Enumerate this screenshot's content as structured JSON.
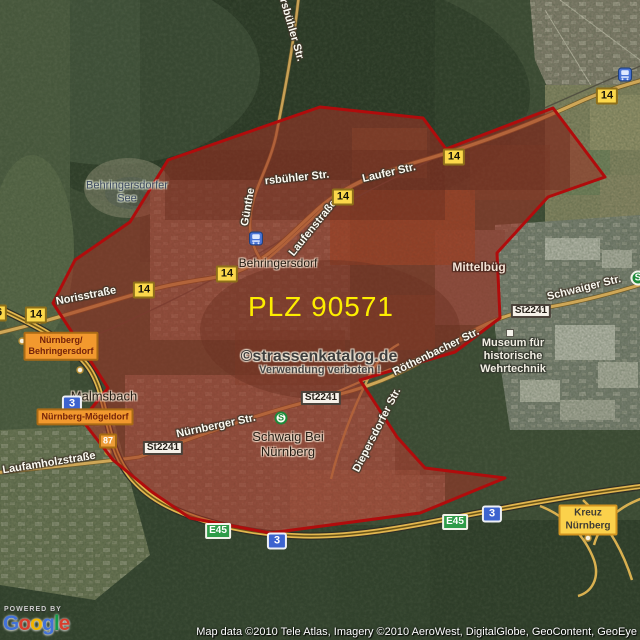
{
  "plz_overlay": {
    "label": "PLZ 90571",
    "fill_color": "#9e3326",
    "border_color": "#b00c0c",
    "label_color": "#fdee00"
  },
  "watermark": {
    "line1": "©strassenkatalog.de",
    "line2": "Verwendung verboten !"
  },
  "places": {
    "see_line1": "Behringersdorfer",
    "see_line2": "See",
    "behringersdorf": "Behringersdorf",
    "mittelbueg": "Mittelbüg",
    "malmsbach": "Malmsbach",
    "schwaig_line1": "Schwaig Bei",
    "schwaig_line2": "Nürnberg",
    "museum_line1": "Museum für",
    "museum_line2": "historische",
    "museum_line3": "Wehrtechnik"
  },
  "streets": {
    "norisstrasse": "Norisstraße",
    "laufer_str": "Laufer Str.",
    "lauferstrasse": "Laufenstraße",
    "guenthersbuehler_vertical": "Günthe",
    "guenthersbuehler_horizontal": "rsbühler Str.",
    "top_edge_street": "ersbühler Str.",
    "schwaiger_str": "Schwaiger Str.",
    "roethenbacher_str": "Röthenbacher Str.",
    "nuernberger_str": "Nürnberger Str.",
    "diepersdorfer_str": "Diepersdorfer Str.",
    "laufamholzstrasse": "Laufamholzstraße"
  },
  "shields": {
    "b14": "14",
    "b36": "36",
    "b87": "87",
    "st2241": "St2241",
    "e45": "E45",
    "a3": "3"
  },
  "signs": {
    "exit_nuernberg_line1": "Nürnberg/",
    "exit_nuernberg_line2": "Behringersdorf",
    "exit_moegeldorf": "Nürnberg-Mögeldorf",
    "kreuz_line1": "Kreuz",
    "kreuz_line2": "Nürnberg",
    "sbahn_letter": "S"
  },
  "attribution": {
    "powered_by": "POWERED BY",
    "google_letters": [
      "G",
      "o",
      "o",
      "g",
      "l",
      "e"
    ],
    "map_data": "Map data ©2010 Tele Atlas, Imagery ©2010 AeroWest, DigitalGlobe, GeoContent, GeoEye"
  }
}
